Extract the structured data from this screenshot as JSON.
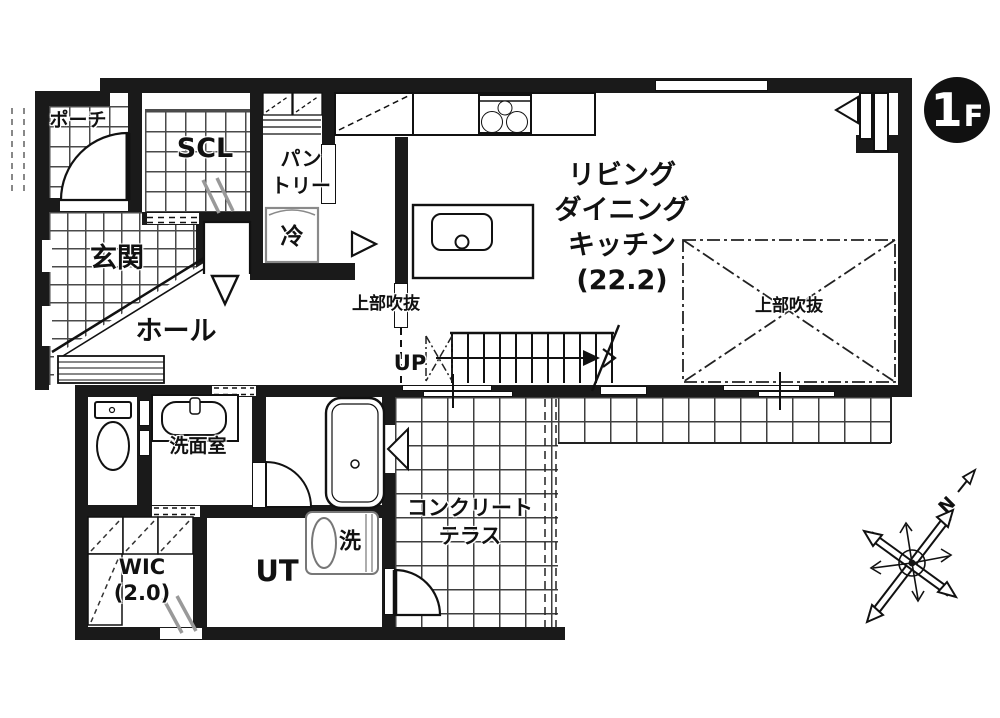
{
  "colors": {
    "ink": "#111111",
    "wall": "#1a1a1a",
    "gray_accent": "#999999"
  },
  "badge": {
    "floor_number": "1",
    "floor_suffix": "F"
  },
  "compass": {
    "north": "N"
  },
  "rooms": {
    "porch": {
      "label": "ポーチ"
    },
    "scl": {
      "label": "SCL"
    },
    "pantry": {
      "label_line1": "パン",
      "label_line2": "トリー"
    },
    "fridge": {
      "label": "冷"
    },
    "genkan": {
      "label": "玄関"
    },
    "hall": {
      "label": "ホール"
    },
    "ldk": {
      "label_line1": "リビング",
      "label_line2": "ダイニング",
      "label_line3": "キッチン",
      "label_line4": "(22.2)"
    },
    "void_left": {
      "label": "上部吹抜"
    },
    "void_right": {
      "label": "上部吹抜"
    },
    "stairs": {
      "label": "UP"
    },
    "washroom": {
      "label": "洗面室"
    },
    "washer": {
      "label": "洗"
    },
    "utility": {
      "label": "UT"
    },
    "wic": {
      "label_line1": "WIC",
      "label_line2": "(2.0)"
    },
    "terrace": {
      "label_line1": "コンクリート",
      "label_line2": "テラス"
    }
  }
}
